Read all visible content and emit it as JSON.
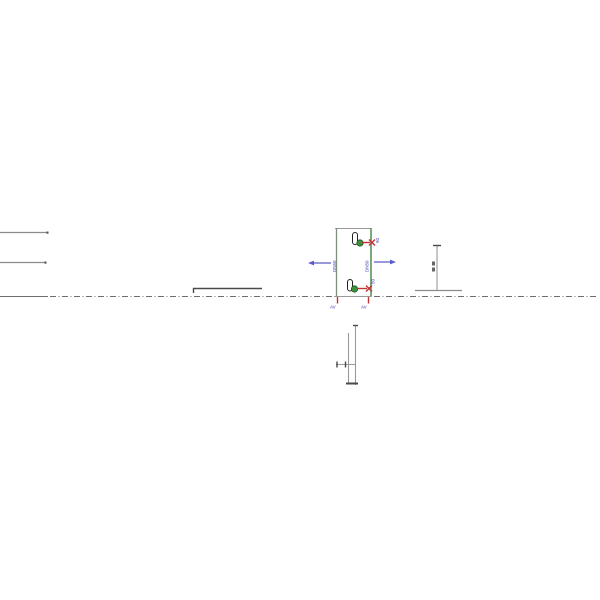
{
  "labels": {
    "pipe_left": "DN50",
    "pipe_right": "DN50",
    "valve_top": "50",
    "valve_bottom": "50",
    "stub_left": "AV",
    "stub_right": "AV"
  },
  "colors": {
    "background": "#ffffff",
    "pipe_green": "#4e8c4e",
    "line_gray": "#8c8c8c",
    "line_dark": "#4a4a4a",
    "centerline_gray": "#6e6e6e",
    "annotation_blue": "#3a3ab8",
    "flow_arrow_blue": "#5a5ac8",
    "flow_red": "#c43232",
    "valve_ball_green": "#3f8f3f"
  }
}
